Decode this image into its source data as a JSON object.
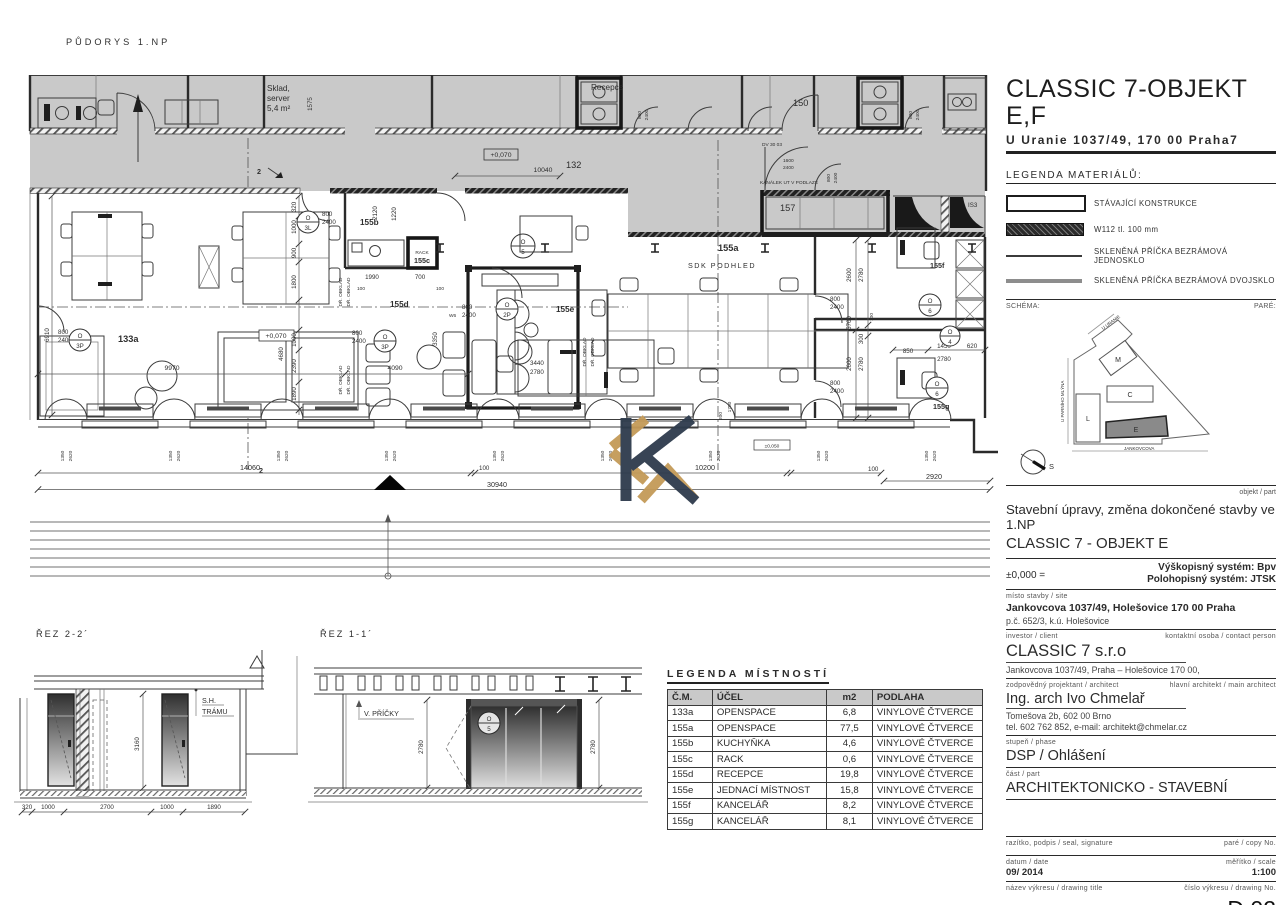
{
  "colors": {
    "plan_gray": "#c9c9c9",
    "line": "#3a3a3a",
    "dark": "#1f1f1f",
    "logo_navy": "#2e3b4c",
    "logo_gold": "#c49a58"
  },
  "plan": {
    "title": "PŮDORYS 1.NP",
    "labels": {
      "sklad_1": "Sklad,",
      "sklad_2": "server",
      "sklad_3": "5,4 m²",
      "recepce": "Recepce",
      "r132": "132",
      "r150": "150",
      "r157": "157",
      "is3": "IS3",
      "r133a": "133a",
      "r155a": "155a",
      "sdk_podhled": "SDK PODHLED",
      "r155b": "155b",
      "r155c": "155c",
      "rack": "RACK",
      "r155d": "155d",
      "r155e": "155e",
      "r155f": "155f",
      "r155g": "155g",
      "dr_obklad": "DŘ. OBKLAD",
      "kanalek": "KANÁLEK UT V PODLAZE",
      "dv3003": "DV 30 03",
      "w6": "W6",
      "lvl_070": "+0,070",
      "lvl_050": "±0,050",
      "sec2": "2"
    },
    "marks": {
      "o": "O",
      "n3l": "3L",
      "n3p": "3P",
      "n2p": "2P",
      "n5": "5",
      "n6": "6",
      "n4": "4"
    },
    "dims": {
      "d10040": "10040",
      "d1575": "1575",
      "d1600": "1600",
      "d14060": "14060",
      "d30940": "30940",
      "d10200": "10200",
      "d2920": "2920",
      "d100": "100",
      "win_w": "1350",
      "win_h": "2620",
      "door_w": "800",
      "door_h": "2400",
      "d320": "320",
      "d1000": "1000",
      "d900": "900",
      "d1800": "1800",
      "d2390": "2390",
      "d1890": "1890",
      "d6910": "6910",
      "d9970": "9970",
      "d4090": "4090",
      "d4680": "4680",
      "d3350": "3350",
      "d3440": "3440",
      "d2780": "2780",
      "d2120": "2120",
      "d1220": "1220",
      "d1990": "1990",
      "d700": "700",
      "d2220": "2220",
      "d5700": "5700",
      "d2600": "2600",
      "d300": "300",
      "d850": "850",
      "d1450": "1450",
      "d620": "620",
      "d200": "200",
      "d1750": "1750"
    }
  },
  "sections": {
    "rez22": {
      "title": "ŘEZ 2-2´",
      "sh_line1": "S.H.",
      "sh_line2": "TRÁMU",
      "height": "3160",
      "dims": [
        "320",
        "1000",
        "2700",
        "1000",
        "1890"
      ]
    },
    "rez11": {
      "title": "ŘEZ 1-1´",
      "v_pricky": "V. PŘÍČKY",
      "dim_left": "2780",
      "dim_right": "2780",
      "mark_letter": "O",
      "mark_num": "5"
    }
  },
  "room_legend": {
    "title": "LEGENDA MÍSTNOSTÍ",
    "headers": [
      "Č.M.",
      "ÚČEL",
      "m2",
      "PODLAHA"
    ],
    "rows": [
      [
        "133a",
        "OPENSPACE",
        "6,8",
        "VINYLOVÉ ČTVERCE"
      ],
      [
        "155a",
        "OPENSPACE",
        "77,5",
        "VINYLOVÉ ČTVERCE"
      ],
      [
        "155b",
        "KUCHYŇKA",
        "4,6",
        "VINYLOVÉ ČTVERCE"
      ],
      [
        "155c",
        "RACK",
        "0,6",
        "VINYLOVÉ ČTVERCE"
      ],
      [
        "155d",
        "RECEPCE",
        "19,8",
        "VINYLOVÉ ČTVERCE"
      ],
      [
        "155e",
        "JEDNACÍ MÍSTNOST",
        "15,8",
        "VINYLOVÉ ČTVERCE"
      ],
      [
        "155f",
        "KANCELÁŘ",
        "8,2",
        "VINYLOVÉ ČTVERCE"
      ],
      [
        "155g",
        "KANCELÁŘ",
        "8,1",
        "VINYLOVÉ ČTVERCE"
      ]
    ]
  },
  "title_block": {
    "project_title": "CLASSIC 7-OBJEKT E,F",
    "address": "U Uranie 1037/49, 170 00 Praha7",
    "legend_title": "LEGENDA MATERIÁLŮ:",
    "legend_items": [
      "STÁVAJÍCÍ KONSTRUKCE",
      "W112 tl. 100 mm",
      "SKLENĚNÁ PŘÍČKA BEZRÁMOVÁ JEDNOSKLO",
      "SKLENĚNÁ PŘÍČKA BEZRÁMOVÁ DVOJSKLO"
    ],
    "schema_label": "SCHÉMA:",
    "pare_label": "PARÉ:",
    "site_plan": {
      "street_top": "U URANIE",
      "street_left": "U PARNÍHO MLÝNA",
      "street_bottom": "JANKOVCOVA",
      "bld_m": "M",
      "bld_c": "C",
      "bld_l": "L",
      "bld_e": "E",
      "compass": "S"
    },
    "objekt_part_label": "objekt / part",
    "subject_line1": "Stavební úpravy, změna dokončené stavby ve 1.NP",
    "subject_line2": "CLASSIC 7 - OBJEKT E",
    "elevation_ref": "±0,000 =",
    "system_height": "Výškopisný systém: Bpv",
    "system_position": "Polohopisný systém: JTSK",
    "site_label": "místo stavby / site",
    "site_address": "Jankovcova 1037/49, Holešovice 170 00 Praha",
    "site_parcel": "p.č. 652/3, k.ú. Holešovice",
    "investor_label": "investor / client",
    "contact_label": "kontaktní osoba / contact person",
    "investor_name": "CLASSIC 7 s.r.o",
    "investor_address": "Jankovcova 1037/49, Praha – Holešovice 170 00,",
    "designer_label": "zodpovědný projektant / architect",
    "main_architect_label": "hlavní architekt / main architect",
    "architect_name": "Ing. arch Ivo Chmelař",
    "architect_address": "Tomešova 2b, 602 00 Brno",
    "architect_contact": "tel. 602 762 852, e-mail: architekt@chmelar.cz",
    "phase_label": "stupeň / phase",
    "phase_value": "DSP / Ohlášení",
    "part_label": "část / part",
    "part_value": "ARCHITEKTONICKO - STAVEBNÍ",
    "seal_label": "razítko, podpis / seal, signature",
    "copy_label": "paré / copy No.",
    "date_label": "datum / date",
    "date_value": "09/ 2014",
    "scale_label": "měřítko / scale",
    "scale_value": "1:100",
    "drawing_title_label": "název výkresu / drawing title",
    "drawing_no_label": "číslo výkresu / drawing No.",
    "drawing_title": "PŮDORYS 1.NP - NÁVRH",
    "drawing_no": "D.02",
    "revision_label": "revize",
    "number_date_label": "číslo/number / datum/date"
  }
}
